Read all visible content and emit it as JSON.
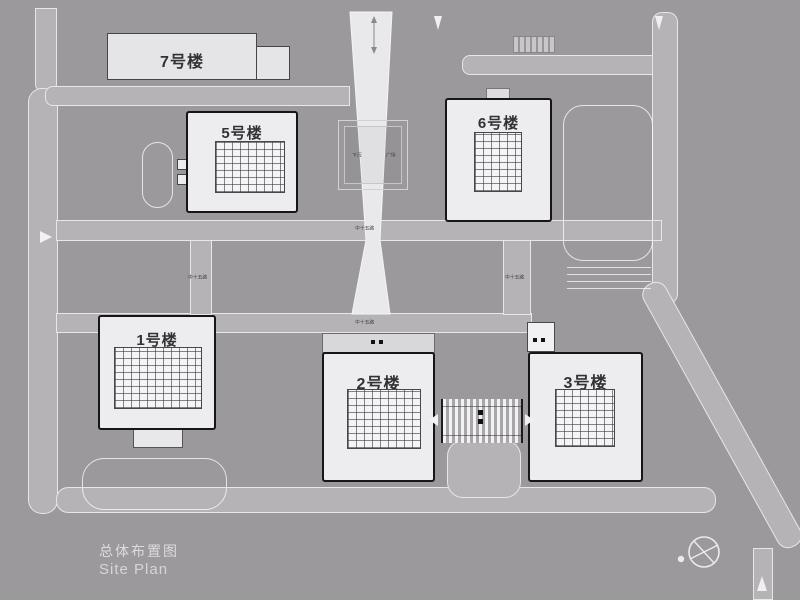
{
  "title": {
    "cn": "总体布置图",
    "en": "Site Plan"
  },
  "buildings": {
    "b1": {
      "label": "1号楼"
    },
    "b2": {
      "label": "2号楼"
    },
    "b3": {
      "label": "3号楼"
    },
    "b5": {
      "label": "5号楼"
    },
    "b6": {
      "label": "6号楼"
    },
    "b7": {
      "label": "7号楼"
    }
  },
  "road_labels": {
    "mid_h_upper": "中十五路",
    "mid_v_left": "中十五路",
    "mid_v_right": "中十五路",
    "mid_h_lower": "中十五路"
  },
  "plaza": {
    "left": "下沉",
    "right": "广场"
  },
  "colors": {
    "background": "#9b999c",
    "road": "#b5b3b6",
    "building_fill": "#edecee",
    "building_border": "#161616",
    "central_band": "#e9e8ea",
    "label_text": "#323234",
    "title_text": "#dcdbdd"
  }
}
